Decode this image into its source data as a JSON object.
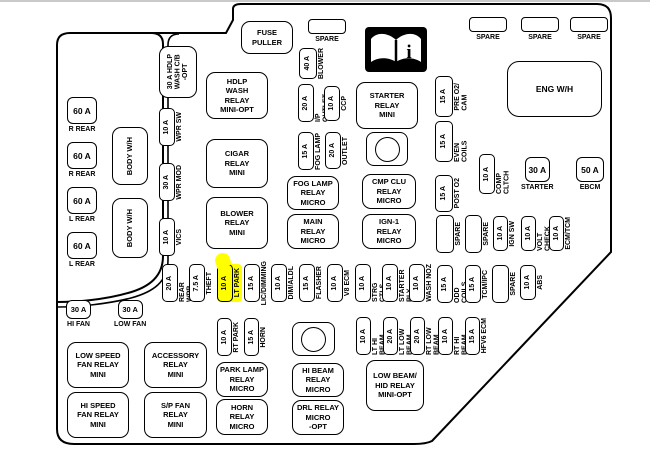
{
  "colors": {
    "highlight": "#ffff00",
    "line": "#000000",
    "icon_bg": "#000000"
  },
  "icons": {
    "owners_manual": "open-book-info-icon"
  },
  "left_strip": {
    "fuses_60a": [
      {
        "amp": "60 A",
        "label": "R REAR"
      },
      {
        "amp": "60 A",
        "label": "R REAR"
      },
      {
        "amp": "60 A",
        "label": "L REAR"
      },
      {
        "amp": "60 A",
        "label": "L REAR"
      }
    ],
    "body_wh": [
      "BODY W/H",
      "BODY W/H"
    ]
  },
  "wpr_column": {
    "hdlp_cb": "30 A HDLP\nWASH C/B\n-OPT",
    "fuses": [
      {
        "amp": "10 A",
        "label": "WPR SW"
      },
      {
        "amp": "30 A",
        "label": "WPR MOD"
      },
      {
        "amp": "10 A",
        "label": "VICS"
      }
    ]
  },
  "top_fuses": {
    "spare_left": "SPARE",
    "spares_right": [
      "SPARE",
      "SPARE",
      "SPARE"
    ],
    "blower": {
      "amp": "40 A",
      "label": "BLOWER"
    },
    "ip_outlet": {
      "amp": "20 A",
      "label": "I/P OUTLET"
    },
    "ccp": {
      "amp": "10 A",
      "label": "CCP"
    },
    "fog_lamp": {
      "amp": "15 A",
      "label": "FOG LAMP"
    },
    "outlet": {
      "amp": "20 A",
      "label": "OUTLET"
    }
  },
  "relays": {
    "fuse_puller": "FUSE\nPULLER",
    "hdlp_wash": "HDLP\nWASH\nRELAY\nMINI-OPT",
    "cigar": "CIGAR\nRELAY\nMINI",
    "blower": "BLOWER\nRELAY\nMINI",
    "fog_lamp": "FOG LAMP\nRELAY\nMICRO",
    "main": "MAIN\nRELAY\nMICRO",
    "starter": "STARTER\nRELAY\nMINI",
    "cmp_clu": "CMP CLU\nRELAY\nMICRO",
    "ign1": "IGN-1\nRELAY\nMICRO",
    "park_lamp": "PARK LAMP\nRELAY\nMICRO",
    "horn": "HORN\nRELAY\nMICRO",
    "hi_beam": "HI BEAM\nRELAY\nMICRO",
    "drl": "DRL RELAY\nMICRO\n-OPT",
    "low_beam_hid": "LOW BEAM/\nHID RELAY\nMINI-OPT",
    "low_speed_fan": "LOW SPEED\nFAN RELAY\nMINI",
    "accessory": "ACCESSORY\nRELAY\nMINI",
    "hi_speed_fan": "HI SPEED\nFAN RELAY\nMINI",
    "sp_fan": "S/P FAN\nRELAY\nMINI",
    "eng_wh": "ENG W/H"
  },
  "right_fuses": {
    "pre_o2": {
      "amp": "15 A",
      "label": "PRE O2/\nCAM"
    },
    "even_coils": {
      "amp": "15 A",
      "label": "EVEN COILS"
    },
    "post_o2": {
      "amp": "15 A",
      "label": "POST O2"
    },
    "comp_cltch": {
      "amp": "10 A",
      "label": "COMP CLTCH"
    },
    "starter": {
      "amp": "30 A",
      "label": "STARTER"
    },
    "ebcm": {
      "amp": "50 A",
      "label": "EBCM"
    },
    "row2": [
      {
        "amp": "",
        "label": "SPARE"
      },
      {
        "amp": "",
        "label": "SPARE"
      },
      {
        "amp": "10 A",
        "label": "IGN SW"
      },
      {
        "amp": "10 A",
        "label": "VOLT CHECK"
      },
      {
        "amp": "10 A",
        "label": "ECM/TCM"
      }
    ]
  },
  "mid_row": [
    {
      "amp": "20 A",
      "label": "REAR WPR"
    },
    {
      "amp": "7.5 A",
      "label": "THEFT"
    },
    {
      "amp": "10 A",
      "label": "LT PARK",
      "highlight": true
    },
    {
      "amp": "15 A",
      "label": "LIC/DIMMING"
    },
    {
      "amp": "10 A",
      "label": "DIM/ALDL"
    },
    {
      "amp": "15 A",
      "label": "FLASHER"
    },
    {
      "amp": "10 A",
      "label": "V8 ECM"
    },
    {
      "amp": "10 A",
      "label": "STRG CTLS"
    },
    {
      "amp": "10 A",
      "label": "STARTER RLY"
    },
    {
      "amp": "10 A",
      "label": "WASH NOZ"
    },
    {
      "amp": "15 A",
      "label": "ODD COILS"
    },
    {
      "amp": "15 A",
      "label": "TCM/IPC"
    },
    {
      "amp": "",
      "label": "SPARE"
    },
    {
      "amp": "10 A",
      "label": "ABS"
    }
  ],
  "beam_row": [
    {
      "amp": "10 A",
      "label": "RT PARK"
    },
    {
      "amp": "15 A",
      "label": "HORN"
    },
    {
      "amp": "10 A",
      "label": "LT HI BEAM"
    },
    {
      "amp": "20 A",
      "label": "LT LOW BEAM"
    },
    {
      "amp": "20 A",
      "label": "RT LOW BEAM"
    },
    {
      "amp": "10 A",
      "label": "RT HI BEAM"
    },
    {
      "amp": "15 A",
      "label": "HFV6 ECM"
    }
  ],
  "bottom_left": {
    "hi_fan": {
      "amp": "30 A",
      "label": "HI FAN"
    },
    "low_fan": {
      "amp": "30 A",
      "label": "LOW FAN"
    }
  }
}
